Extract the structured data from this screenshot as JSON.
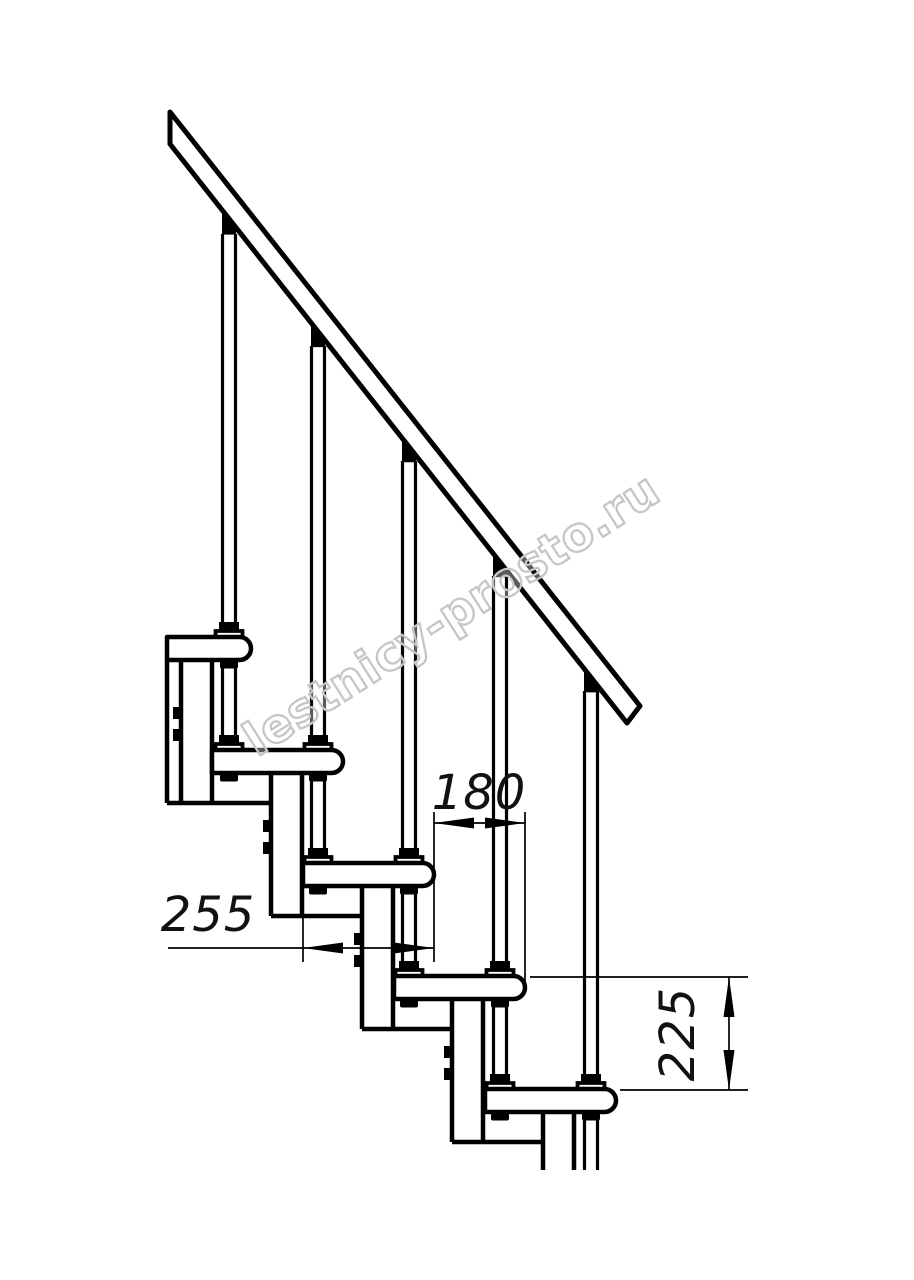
{
  "drawing": {
    "type_label": "staircase-side-elevation",
    "background_color": "#ffffff",
    "line_color": "#000000",
    "watermark_color": "#c6c6c6"
  },
  "watermark": {
    "text": "lestnicy-prosto.ru"
  },
  "dimensions": {
    "step_offset": {
      "value": "180"
    },
    "tread_depth": {
      "value": "255"
    },
    "step_rise": {
      "value": "225"
    }
  }
}
